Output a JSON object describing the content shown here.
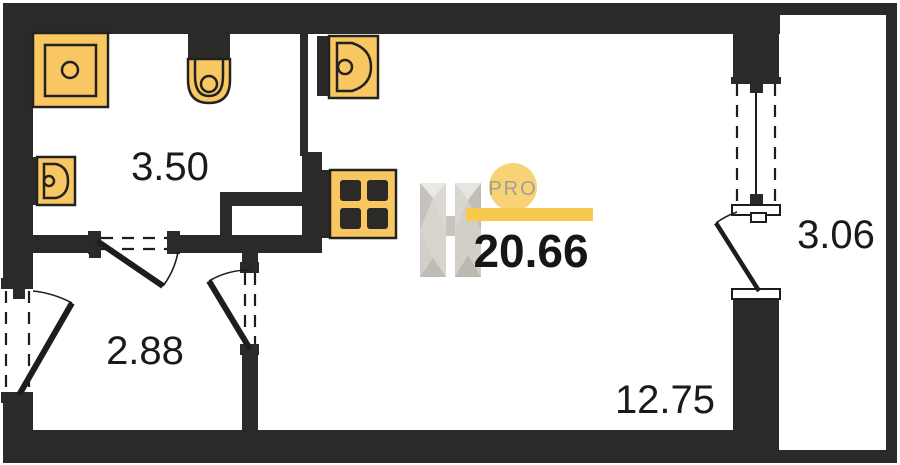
{
  "plan": {
    "total_area": "20.66",
    "rooms": {
      "bathroom": {
        "label": "3.50"
      },
      "hallway": {
        "label": "2.88"
      },
      "living_room": {
        "label": "12.75"
      },
      "balcony": {
        "label": "3.06"
      }
    },
    "fixtures": [
      "shower-icon",
      "toilet-icon",
      "washbasin-icon",
      "kitchen-sink-icon",
      "stove-icon"
    ]
  },
  "logo": {
    "badge": "PRO",
    "letter": "H"
  },
  "colors": {
    "wall": "#2B2A28",
    "fixture_fill": "#F8C761",
    "fixture_stroke": "#242220",
    "logo_circle": "#F7D376",
    "logo_bar": "#F7CA4E",
    "logo_text": "#A39F97",
    "area_text": "#1B1A18"
  }
}
